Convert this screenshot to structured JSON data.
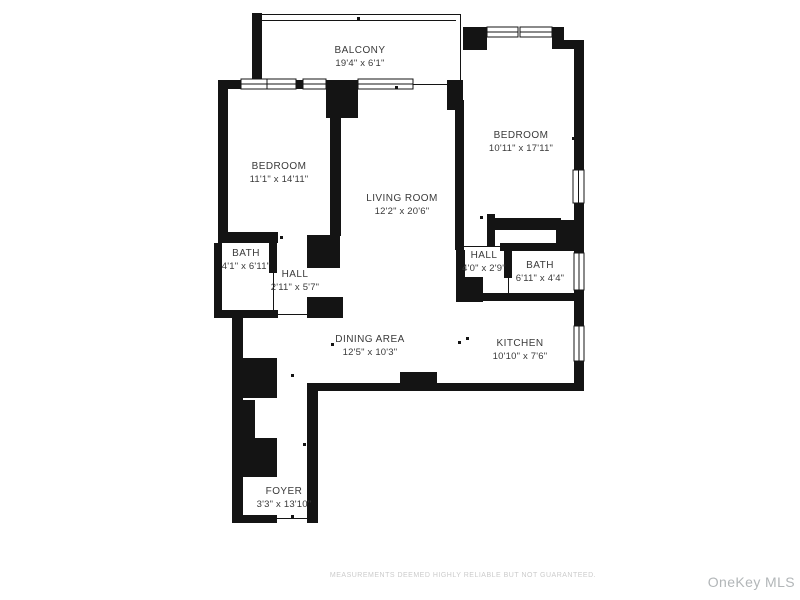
{
  "floorplan": {
    "rooms": [
      {
        "name": "BALCONY",
        "dims": "19'4\" x 6'1\""
      },
      {
        "name": "BEDROOM",
        "dims": "11'1\" x 14'11\""
      },
      {
        "name": "LIVING ROOM",
        "dims": "12'2\" x 20'6\""
      },
      {
        "name": "BEDROOM",
        "dims": "10'11\" x 17'11\""
      },
      {
        "name": "BATH",
        "dims": "4'1\" x 6'11\""
      },
      {
        "name": "HALL",
        "dims": "2'11\" x 5'7\""
      },
      {
        "name": "HALL",
        "dims": "4'0\" x 2'9\""
      },
      {
        "name": "BATH",
        "dims": "6'11\" x 4'4\""
      },
      {
        "name": "DINING AREA",
        "dims": "12'5\" x 10'3\""
      },
      {
        "name": "KITCHEN",
        "dims": "10'10\" x 7'6\""
      },
      {
        "name": "FOYER",
        "dims": "3'3\" x 13'10\""
      }
    ],
    "disclaimer": "MEASUREMENTS DEEMED HIGHLY RELIABLE BUT NOT GUARANTEED.",
    "watermark": "OneKey MLS",
    "colors": {
      "wall": "#141414",
      "label": "#3a3a3a",
      "disclaimer": "#cbcbcb",
      "watermark": "#b2b6b8",
      "background": "#ffffff"
    }
  }
}
